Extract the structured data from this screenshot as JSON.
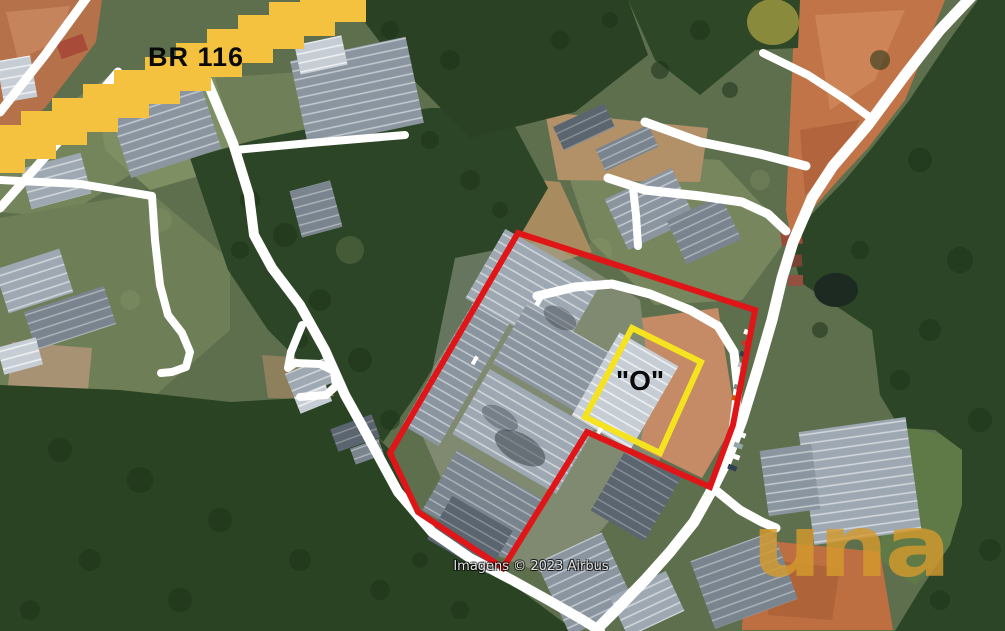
{
  "map": {
    "road_label": "BR 116",
    "parcel_label": "\"O\"",
    "attribution": "Imagens © 2023 Airbus",
    "watermark_text": "una"
  },
  "colors": {
    "highway_overlay": "#F4C23F",
    "boundary_red": "#E01518",
    "boundary_yellow": "#F5E320",
    "road_white": "#FFFFFF",
    "label_black": "#0A0A0A",
    "watermark_gold": "#D49A2E"
  }
}
